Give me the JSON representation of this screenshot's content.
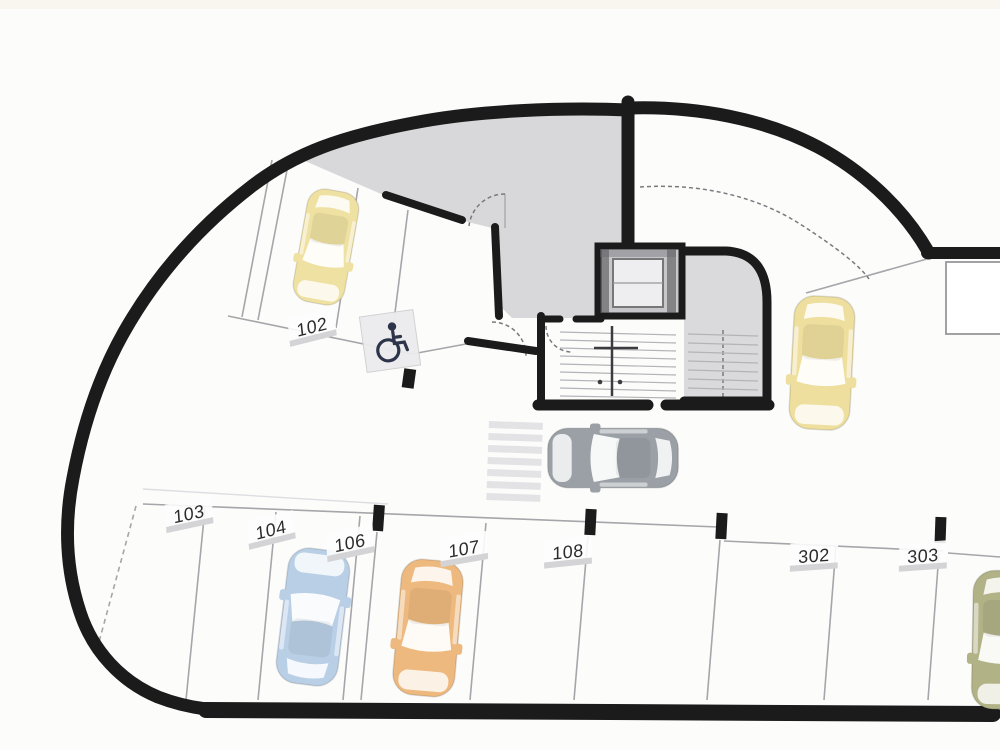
{
  "plan": {
    "type": "parking-garage-floor-plan",
    "spots": [
      {
        "label": "102",
        "status": "occupied"
      },
      {
        "label": "103",
        "status": "empty"
      },
      {
        "label": "104",
        "status": "empty"
      },
      {
        "label": "106",
        "status": "occupied"
      },
      {
        "label": "107",
        "status": "occupied"
      },
      {
        "label": "108",
        "status": "empty"
      },
      {
        "label": "302",
        "status": "empty"
      },
      {
        "label": "303",
        "status": "empty"
      }
    ]
  },
  "cars": [
    {
      "id": "car-spot-102",
      "color": "#efe1a2"
    },
    {
      "id": "car-lane-gray",
      "color": "#9aa0a5"
    },
    {
      "id": "car-aisle-yellow",
      "color": "#eedf9e"
    },
    {
      "id": "car-spot-106",
      "color": "#b9cfe6"
    },
    {
      "id": "car-spot-107",
      "color": "#edb97e"
    },
    {
      "id": "car-right-olive",
      "color": "#b2b287"
    }
  ],
  "colors": {
    "wall": "#1b1b1b",
    "room_fill": "#d8d8db",
    "stair_fill": "#dadadd",
    "elevator_fill": "#c7c7cb",
    "line": "#a6a6aa",
    "label_text": "#2b2b2b",
    "handicap": "#2e3449",
    "crosswalk": "#e3e3e6"
  },
  "icons": {
    "accessible_parking_icon": "wheelchair-symbol"
  }
}
